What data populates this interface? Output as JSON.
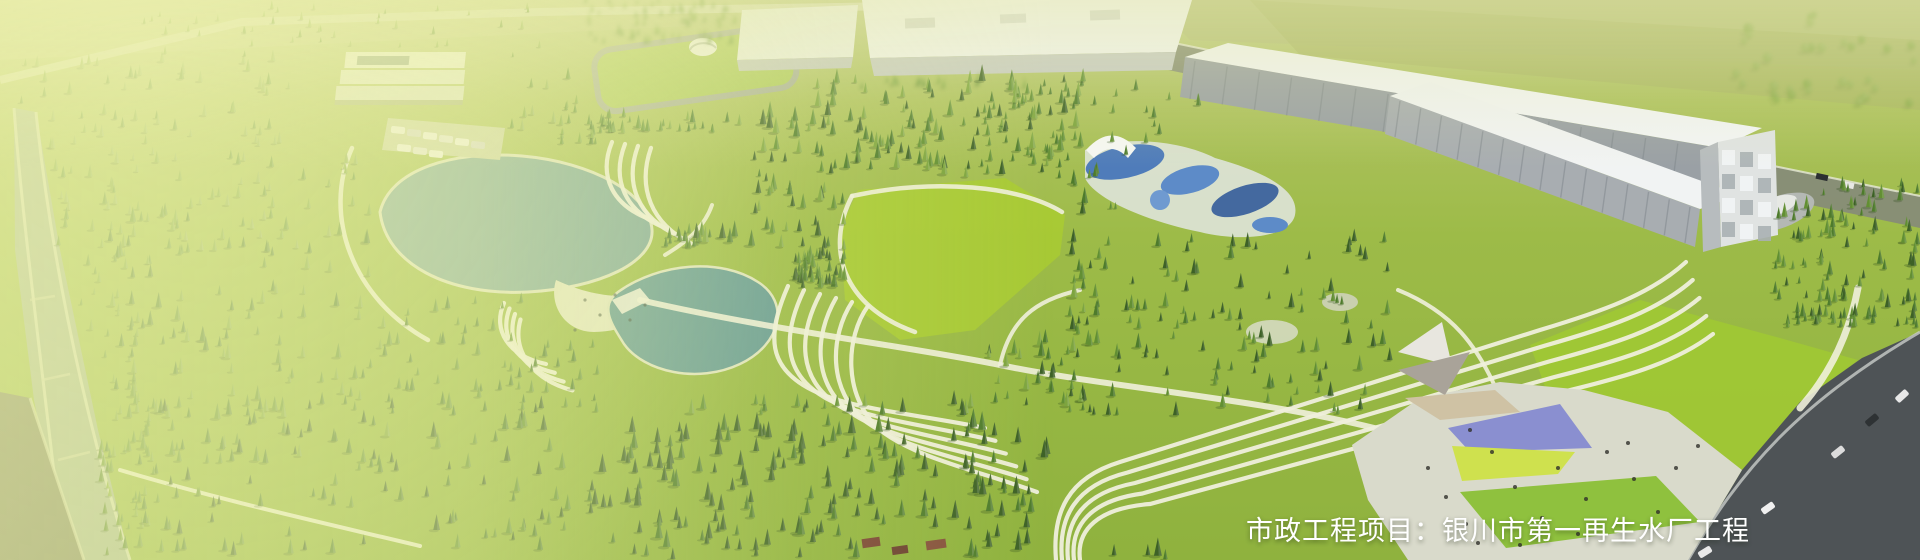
{
  "caption": {
    "text": "市政工程项目：银川市第一再生水厂工程"
  },
  "palette": {
    "wash": "#edf2a7",
    "base_green": "#9cbb47",
    "lawn": "#a9cb33",
    "tree_dark": "#3d6126",
    "tree_mid": "#4e7b2c",
    "tree_light": "#628f33",
    "tree_pale": "#7da43f",
    "tree_olive": "#8fae52",
    "lake": "#7fa99c",
    "pond": "#649a95",
    "river": "#a3b39b",
    "path": "#efefdc",
    "building": "#f2f4f4",
    "facade": "#9aa0a5",
    "road": "#4e5356",
    "plaza": "#d9dacb",
    "canopy_purple": "#8a8fd0",
    "canopy_yellow": "#cfe14e",
    "caption_color": "#ffffff"
  }
}
